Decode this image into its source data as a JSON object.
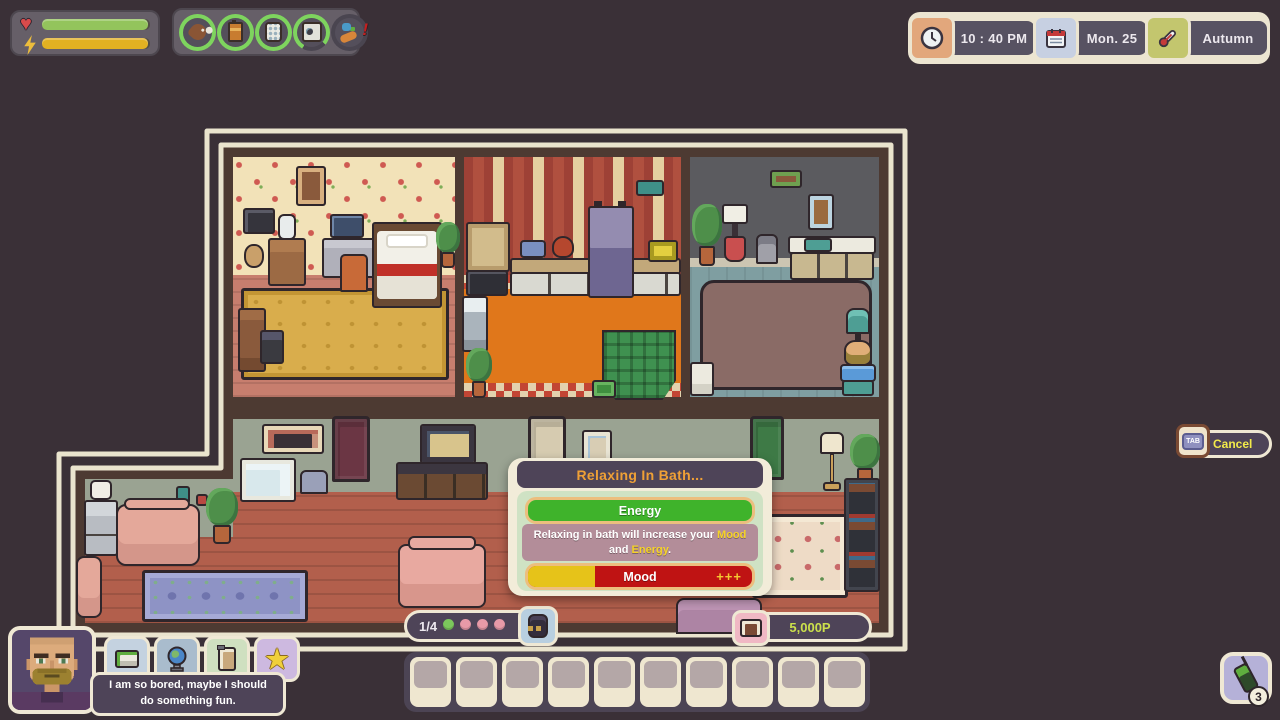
{
  "hud": {
    "vitals": {
      "health_pct": 98,
      "energy_pct": 98,
      "health_color": "#93c45c",
      "energy_color": "#e2b122"
    },
    "needs": [
      {
        "name": "hunger",
        "icon": "drumstick-icon",
        "ring_pct": 100
      },
      {
        "name": "energy",
        "icon": "battery-icon",
        "ring_pct": 100
      },
      {
        "name": "hygiene",
        "icon": "soap-icon",
        "ring_pct": 100
      },
      {
        "name": "bladder",
        "icon": "washer-icon",
        "ring_pct": 78
      },
      {
        "name": "social",
        "icon": "social-alert-icon",
        "ring_pct": 0,
        "alert": "!"
      }
    ],
    "datetime": {
      "time": "10 : 40 PM",
      "date": "Mon. 25",
      "season": "Autumn"
    }
  },
  "action_popup": {
    "title": "Relaxing In Bath...",
    "energy_bar": {
      "label": "Energy",
      "fill_pct": 100,
      "fill_color": "#3fb32b"
    },
    "description_segments": [
      {
        "text": "Relaxing in bath will increase your ",
        "highlight": false
      },
      {
        "text": "Mood",
        "highlight": true
      },
      {
        "text": " and ",
        "highlight": false
      },
      {
        "text": "Energy",
        "highlight": true
      },
      {
        "text": ".",
        "highlight": false
      }
    ],
    "mood_bar": {
      "label": "Mood",
      "bonus": "+++",
      "fill_pct": 30,
      "fill_color": "#e6c319",
      "rest_color": "#bf1313"
    }
  },
  "cancel": {
    "key_label": "TAB",
    "label": "Cancel"
  },
  "money": {
    "amount": "5,000P"
  },
  "pager": {
    "label": "1/4",
    "dots": [
      "active",
      "inactive",
      "inactive",
      "inactive"
    ],
    "active_color": "#7cc75c",
    "inactive_color": "#e89aa8"
  },
  "hotbar": {
    "slot_count": 10
  },
  "character": {
    "speech": "I am so bored, maybe I should do something fun."
  },
  "notifications": {
    "count": "3"
  }
}
